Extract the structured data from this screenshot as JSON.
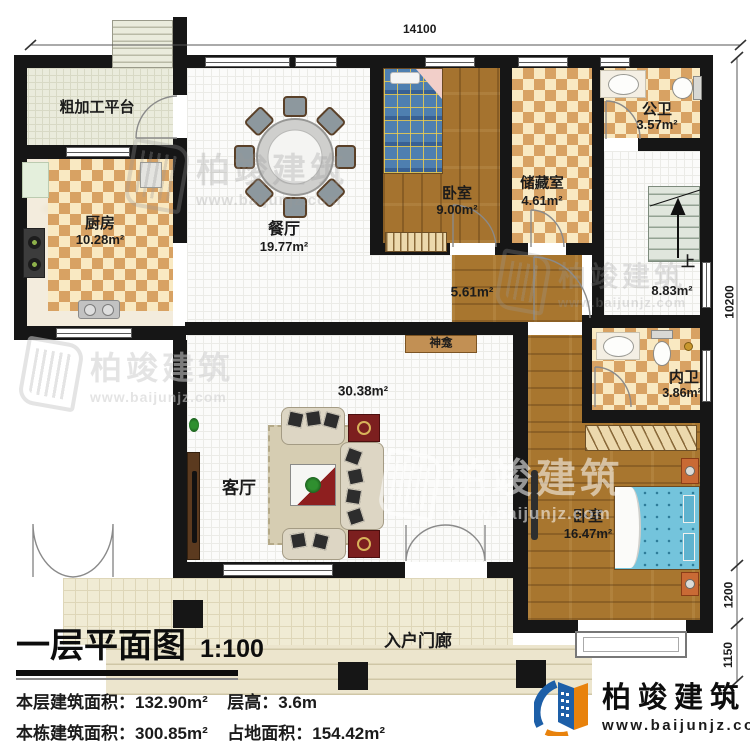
{
  "plan": {
    "rooms": {
      "platform": {
        "label": "粗加工平台"
      },
      "kitchen": {
        "label": "厨房",
        "area": "10.28m²"
      },
      "dining": {
        "label": "餐厅",
        "area": "19.77m²"
      },
      "bedroom_top": {
        "label": "卧室",
        "area": "9.00m²"
      },
      "storage": {
        "label": "储藏室",
        "area": "4.61m²"
      },
      "public_bath": {
        "label": "公卫",
        "area": "3.57m²"
      },
      "stair_hall": {
        "up_label": "上",
        "area": "8.83m²"
      },
      "hallway": {
        "area": "5.61m²"
      },
      "shrine": {
        "label": "神龛"
      },
      "private_bath": {
        "label": "内卫",
        "area": "3.86m²"
      },
      "living": {
        "label": "客厅",
        "area": "30.38m²"
      },
      "master_bedroom": {
        "label": "卧室",
        "area": "16.47m²"
      },
      "porch": {
        "label": "入户门廊"
      }
    },
    "dimensions": {
      "top_width": "14100",
      "right_main": "10200",
      "right_bay": "1200",
      "right_porch": "1150"
    }
  },
  "title_block": {
    "title": "一层平面图",
    "scale": "1:100",
    "stats": [
      {
        "label1": "本层建筑面积：",
        "value1": "132.90m²",
        "label2": "层高：",
        "value2": "3.6m"
      },
      {
        "label1": "本栋建筑面积：",
        "value1": "300.85m²",
        "label2": "占地面积：",
        "value2": "154.42m²"
      }
    ]
  },
  "branding": {
    "name": "柏竣建筑",
    "website": "www.baijunjz.com"
  },
  "watermark": {
    "text": "柏竣建筑",
    "url": "www.baijunjz.com"
  },
  "colors": {
    "wall": "#161616",
    "checker_tile": "#d8a263",
    "wood_floor": "#a5722f",
    "brand_blue": "#1d5fa8",
    "brand_orange": "#e8820c",
    "bed_blue": "#74c4dc"
  }
}
